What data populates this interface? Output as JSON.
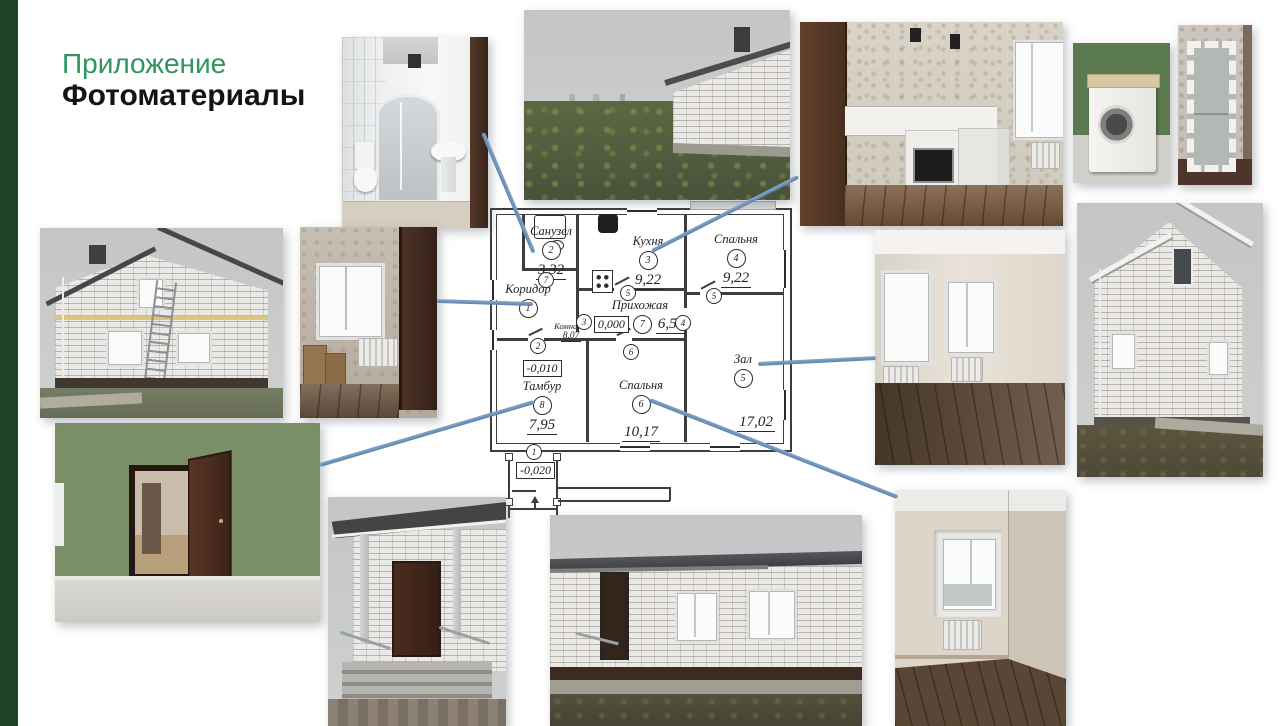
{
  "slide": {
    "title_line1": "Приложение",
    "title_line2": "Фотоматериалы",
    "colors": {
      "accent_green": "#2e9560",
      "sidebar_green": "#1c4324",
      "connector_blue": "#6189b2"
    }
  },
  "plan": {
    "rooms": [
      {
        "name": "Санузел",
        "num": "2",
        "area": "3,32"
      },
      {
        "name": "Кухня",
        "num": "3",
        "area": "9,22"
      },
      {
        "name": "Спальня",
        "num": "4",
        "area": "9,22"
      },
      {
        "name": "Коридор",
        "num": "1",
        "area": ""
      },
      {
        "name": "Прихожая",
        "num": "7",
        "area": "6,53"
      },
      {
        "name": "Комната",
        "num": "",
        "area": "8,07"
      },
      {
        "name": "Тамбур",
        "num": "8",
        "area": "7,95"
      },
      {
        "name": "Спальня",
        "num": "6",
        "area": "10,17"
      },
      {
        "name": "Зал",
        "num": "5",
        "area": "17,02"
      }
    ],
    "levels": {
      "entry_hall": "0,000",
      "tambur": "-0,010",
      "porch": "-0,020"
    },
    "door_tags": [
      "7",
      "5",
      "5",
      "3",
      "4",
      "2",
      "6",
      "1"
    ]
  },
  "photos": [
    {
      "id": "bathroom-shower"
    },
    {
      "id": "street-view-house"
    },
    {
      "id": "kitchen-stove"
    },
    {
      "id": "washing-machine"
    },
    {
      "id": "fridge-packed"
    },
    {
      "id": "house-side-ladder"
    },
    {
      "id": "corridor-room-window"
    },
    {
      "id": "living-room-two-windows"
    },
    {
      "id": "house-gable-exterior"
    },
    {
      "id": "green-room-open-door"
    },
    {
      "id": "entrance-porch"
    },
    {
      "id": "house-front-facade"
    },
    {
      "id": "bedroom-window"
    }
  ]
}
